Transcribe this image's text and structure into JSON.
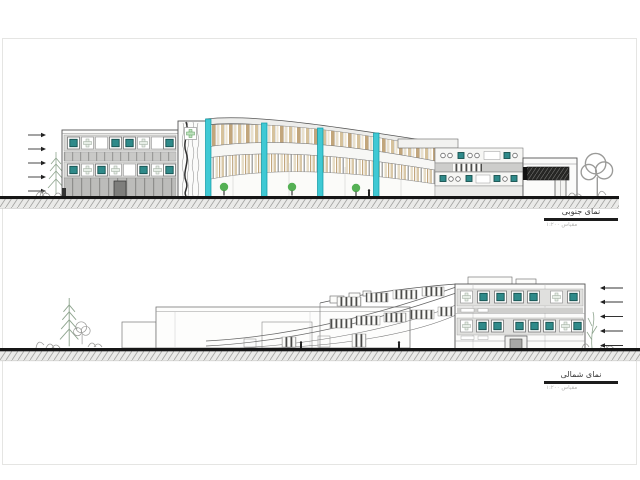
{
  "elevations": {
    "south": {
      "label": "نمای جنوبی",
      "scale_note": "مقیاس ۱:۲۰۰"
    },
    "north": {
      "label": "نمای شمالی",
      "scale_note": "مقیاس ۱:۲۰۰"
    }
  },
  "icons": {
    "level_arrow_right": "right-arrow level marker",
    "level_arrow_left": "left-arrow level marker",
    "conifer_tree": "conifer-tree sketch",
    "deciduous_tree": "deciduous-tree sketch",
    "green_tree": "green tree",
    "teal_window": "teal framed window",
    "cross_window": "cross motif window"
  },
  "colors": {
    "accent-cyan": "#3FC9D4",
    "teal-window": "#2F8A8A",
    "tan-louver": "#D6C29C",
    "tan-dark": "#C2A67C",
    "cream": "#EFE6D2",
    "gray-band": "#C7C7C5",
    "ground-black": "#161616",
    "hatch-gray": "#A5A5A3",
    "tree-green": "#54B054",
    "sketch-green": "#8FA58F",
    "paper": "#FFFFFF",
    "sheet-border": "#E5E5E3"
  }
}
